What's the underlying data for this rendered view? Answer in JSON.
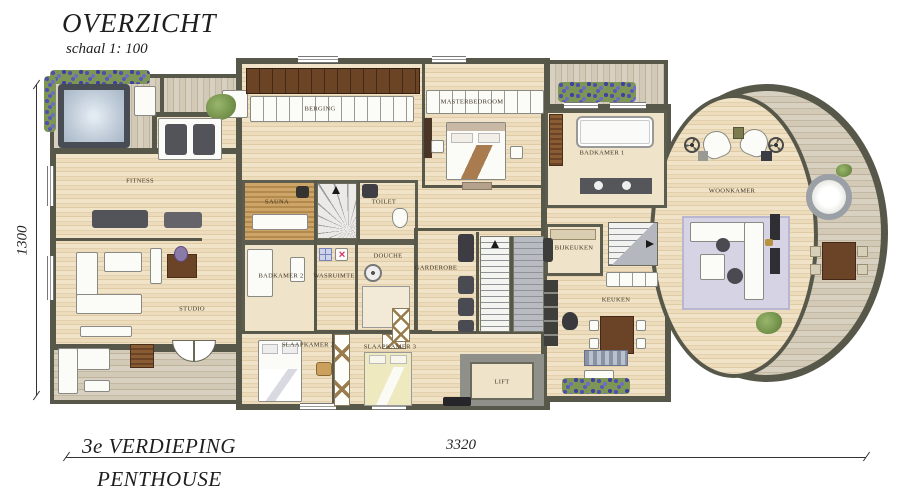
{
  "title": {
    "main": "OVERZICHT",
    "scale": "schaal 1: 100"
  },
  "floor_label": {
    "line1": "3e VERDIEPING",
    "line2": "PENTHOUSE"
  },
  "dimensions": {
    "height_mm": "1300",
    "width_mm": "3320"
  },
  "rooms": {
    "fitness": "FITNESS",
    "sauna": "SAUNA",
    "toilet": "TOILET",
    "badkamer2": "BADKAMER 2",
    "wasruimte": "WASRUIMTE",
    "douche": "DOUCHE",
    "berging": "BERGING",
    "studio": "STUDIO",
    "slaapkamer2": "SLAAPKAMER 2",
    "slaapkamer3": "SLAAPKAMER 3",
    "garderobe": "GARDEROBE",
    "lift": "LIFT",
    "masterbedroom": "MASTERBEDROOM",
    "badkamer1": "BADKAMER 1",
    "bijkeuken": "BIJKEUKEN",
    "keuken": "KEUKEN",
    "woonkamer": "WOONKAMER"
  },
  "icons": {
    "cross_mark": "✕"
  },
  "colors": {
    "wall": "#57584a",
    "floor": "#ead9ba",
    "deck": "#d2c9b6",
    "flower_purple": "#5c5cae",
    "plant_green": "#7d9655",
    "water_blue": "#bcc8d6"
  }
}
